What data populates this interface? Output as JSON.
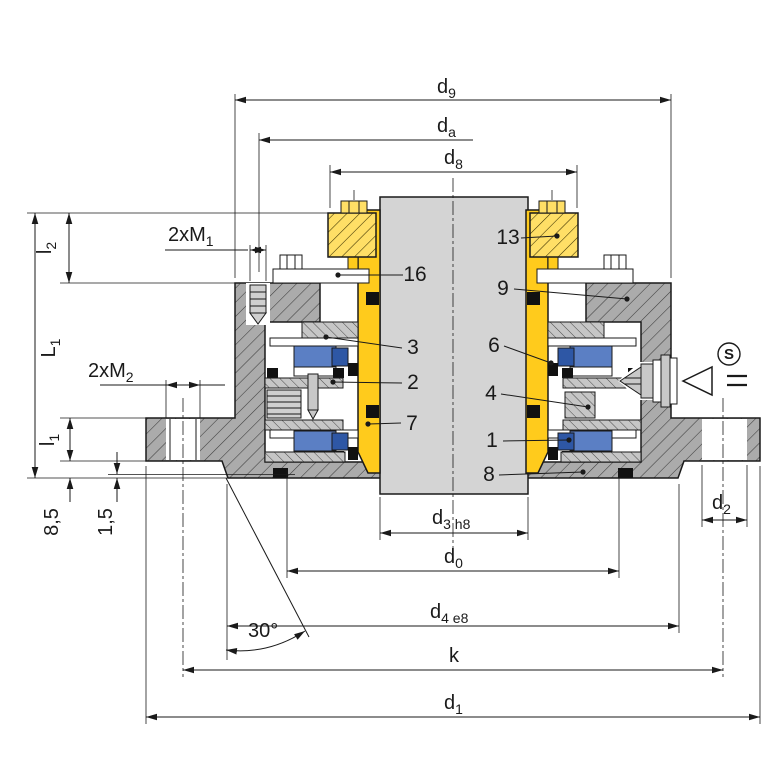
{
  "title": "Mechanical seal cross-section drawing",
  "dims": {
    "d9": {
      "base": "d",
      "sub": "9"
    },
    "da": {
      "base": "d",
      "sub": "a"
    },
    "d8": {
      "base": "d",
      "sub": "8"
    },
    "d3": {
      "base": "d",
      "sub": "3 h8"
    },
    "d0": {
      "base": "d",
      "sub": "0"
    },
    "d4": {
      "base": "d",
      "sub": "4 e8"
    },
    "k": {
      "base": "k",
      "sub": ""
    },
    "d1": {
      "base": "d",
      "sub": "1"
    },
    "d2": {
      "base": "d",
      "sub": "2"
    },
    "L1": {
      "base": "L",
      "sub": "1"
    },
    "l1": {
      "base": "l",
      "sub": "1"
    },
    "l2": {
      "base": "l",
      "sub": "2"
    },
    "m1": {
      "base": "2xM",
      "sub": "1"
    },
    "m2": {
      "base": "2xM",
      "sub": "2"
    },
    "offset85": {
      "base": "8,5",
      "sub": ""
    },
    "offset15": {
      "base": "1,5",
      "sub": ""
    },
    "angle": {
      "base": "30°",
      "sub": ""
    }
  },
  "parts": [
    {
      "number": "1"
    },
    {
      "number": "2"
    },
    {
      "number": "3"
    },
    {
      "number": "4"
    },
    {
      "number": "6"
    },
    {
      "number": "7"
    },
    {
      "number": "8"
    },
    {
      "number": "9"
    },
    {
      "number": "13"
    },
    {
      "number": "16"
    }
  ],
  "symbols": {
    "flush": "S"
  },
  "colors": {
    "sleeve": "#ffcb1c",
    "clamp_ring": "#ffdf66",
    "seal_ring": "#5b7fc4",
    "seal_ring_dark": "#2e57a5",
    "housing": "#ababab",
    "retainer": "#c6c6c6",
    "shaft": "#d4d4d4",
    "line": "#1a1a1a"
  }
}
